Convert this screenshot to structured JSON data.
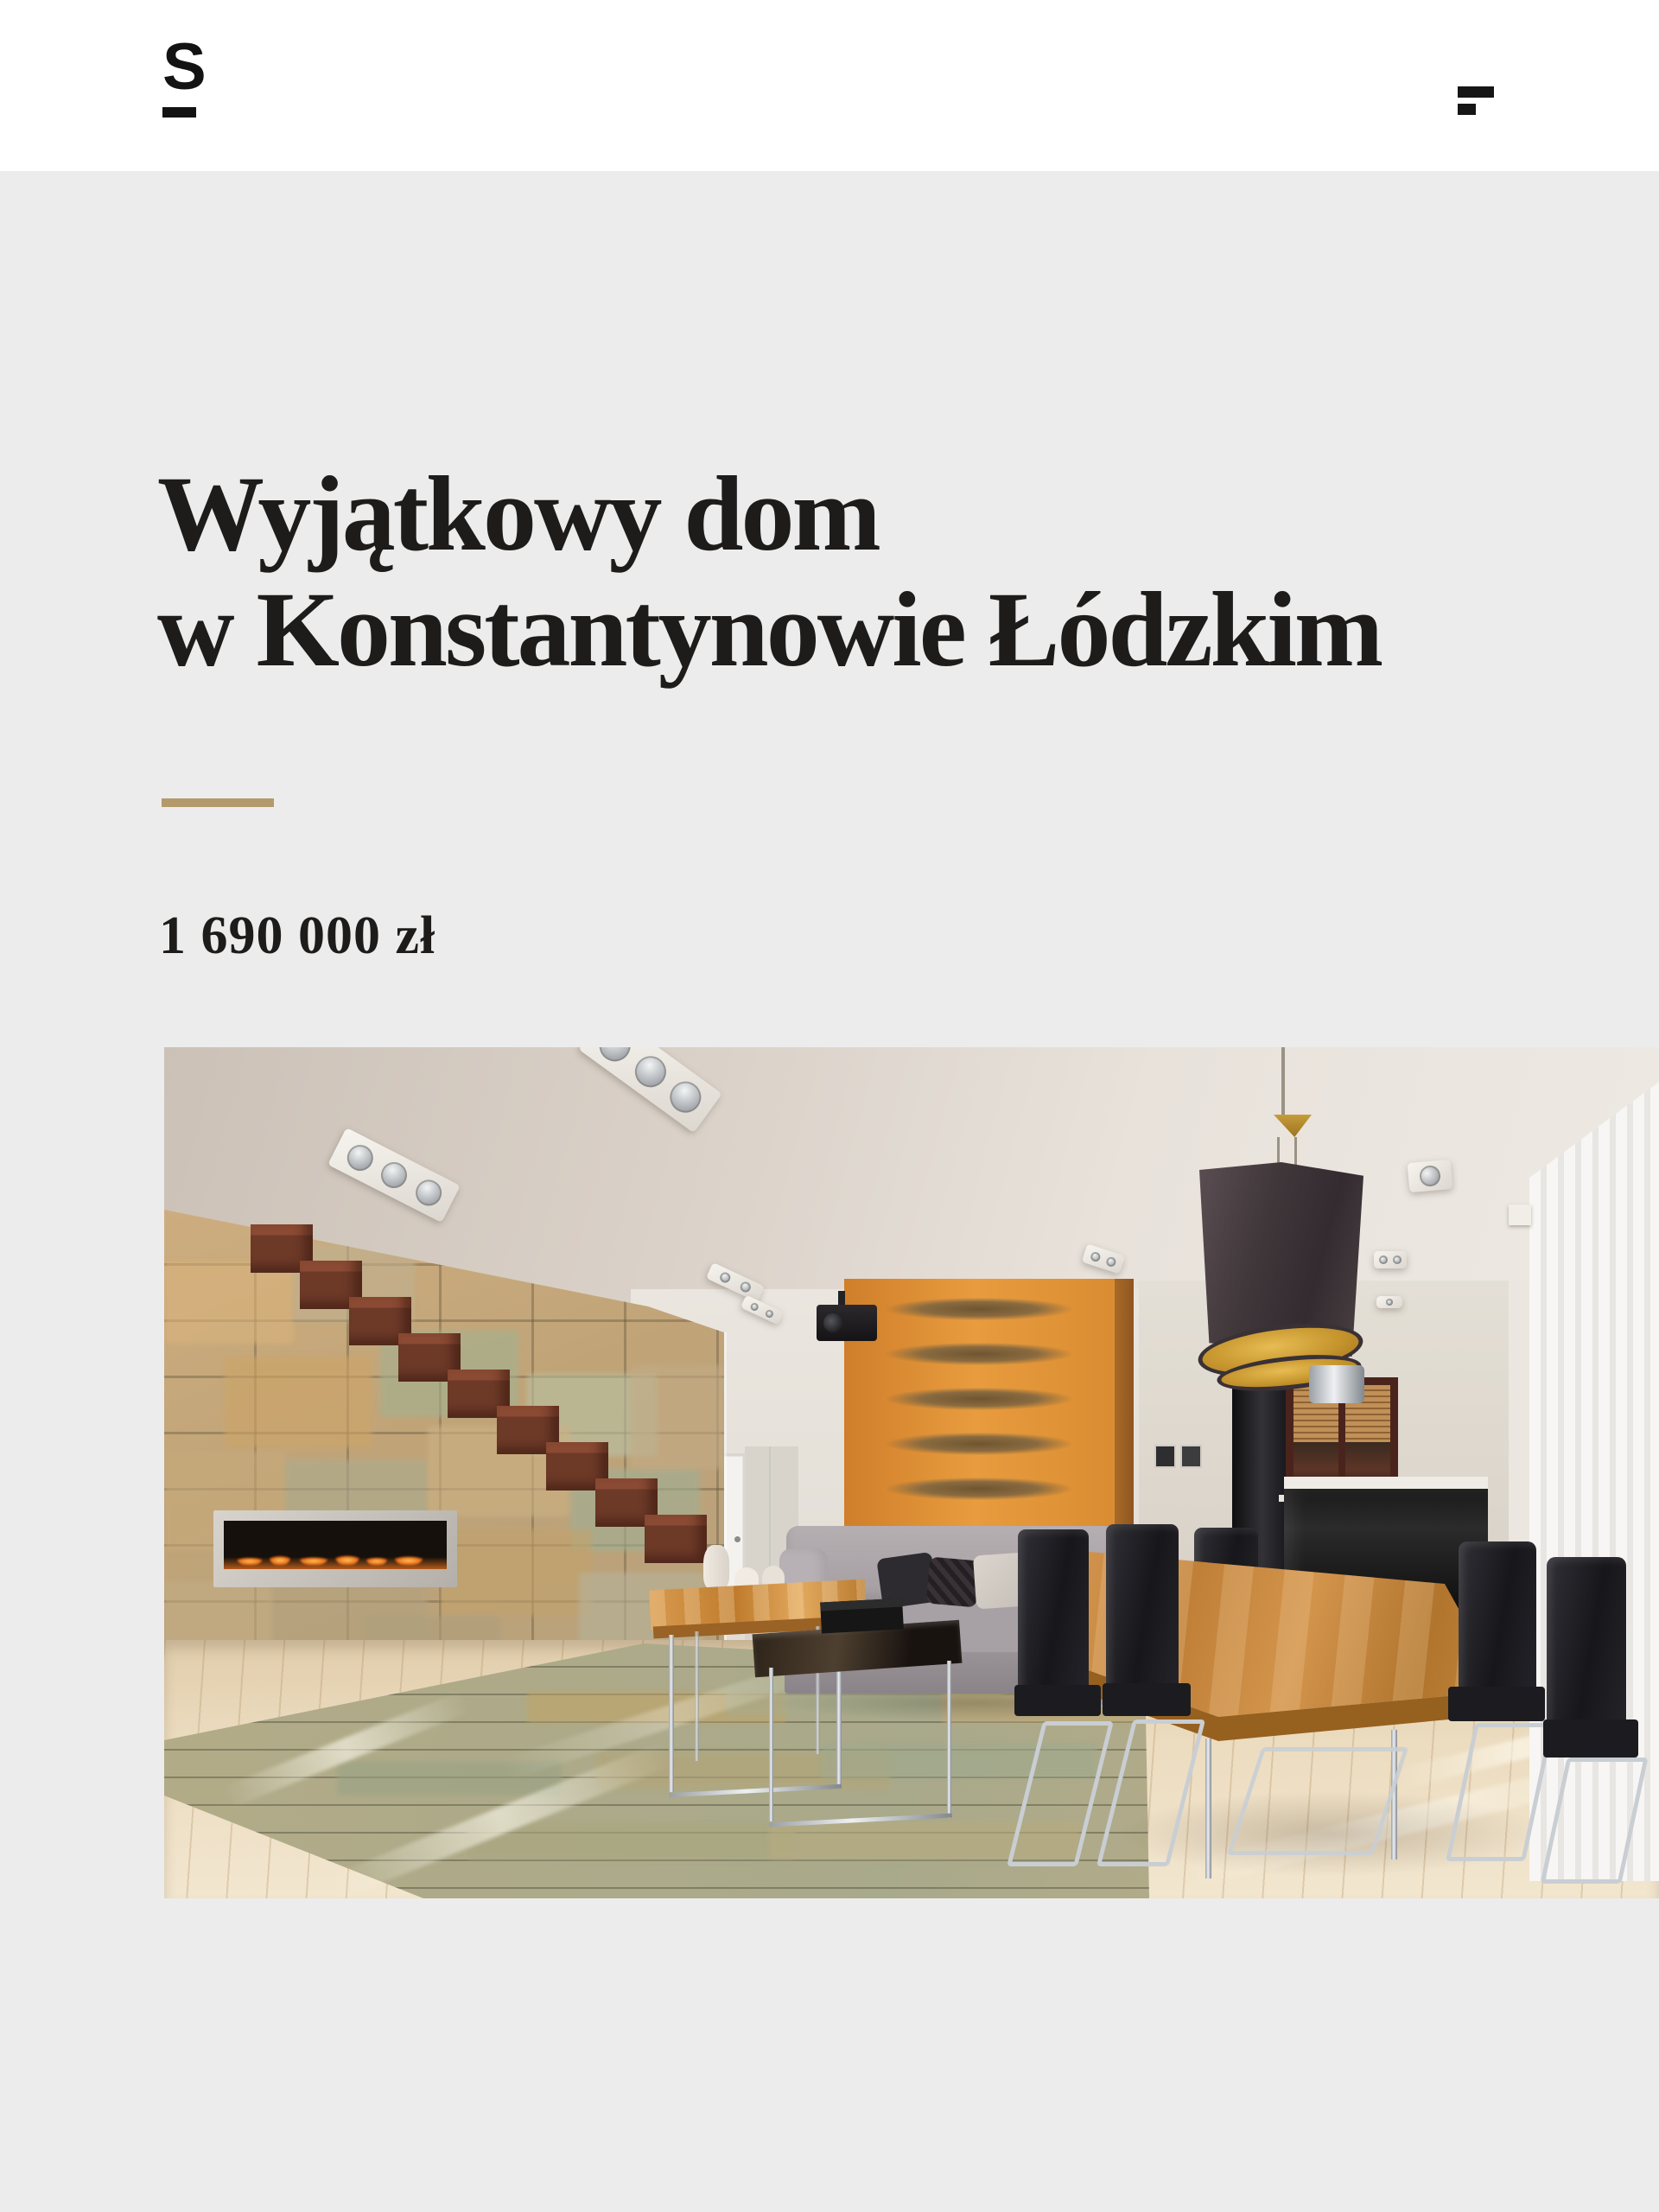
{
  "theme": {
    "page_bg": "#ececec",
    "header_bg": "#ffffff",
    "ink": "#1d1c1a",
    "accent": "#b49a6b"
  },
  "header": {
    "logo": "S",
    "menu_label": "menu"
  },
  "listing": {
    "title_line1": "Wyjątkowy dom",
    "title_line2": "w Konstantynowie Łódzkim",
    "price": "1 690 000 zł"
  },
  "photo": {
    "description": "Przestronny salon: kamienna ściana z kominkiem, drewniane schody, szara sofa, pomarańczowa ściana z drewna, czarna lampa wisząca ze złotym wnętrzem, drewniany stół jadalniany z czarnymi krzesłami, jasna drewniana podłoga z łupkowym dywanem"
  }
}
